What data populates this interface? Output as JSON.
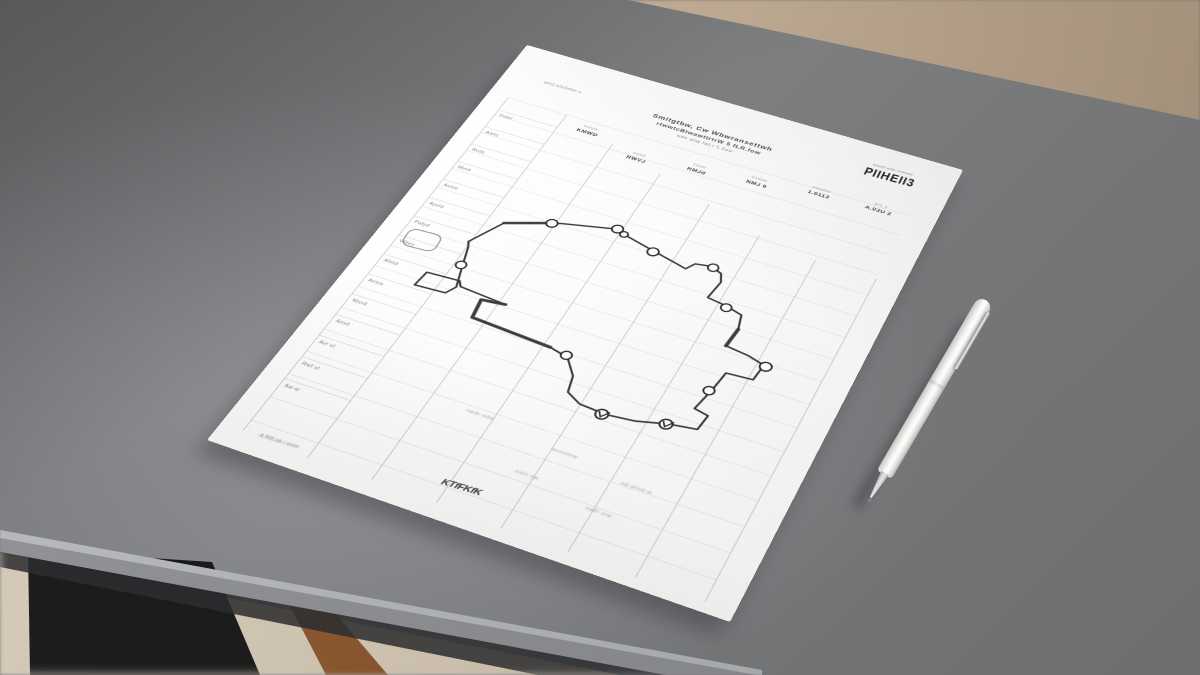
{
  "scene": {
    "description": "Photograph: printed worksheet with hand-drawn flowchart loop on a gray desk, white ballpoint pen beside it, wooden floor beyond desk edges, dark bag and wooden table leg visible under the front edge",
    "objects": [
      "paper-worksheet",
      "ballpoint-pen",
      "gray-desk",
      "wood-floor",
      "table-leg",
      "dark-bag"
    ],
    "colors": {
      "desk": "#757779",
      "desk_edge_highlight": "#b8babc",
      "floor_upper": "#c0ab94",
      "floor_lower": "#cfc3b2",
      "wood_leg": "#8a5a33",
      "bag": "#131316",
      "paper": "#fbfbfa",
      "ink": "#2b2b33",
      "grid_line": "#b6b7bd",
      "pen_body": "#f5f4f2",
      "pen_metal": "#b9babc"
    }
  },
  "paper": {
    "corner_note": "wnd-ataSdwr-c",
    "title_line1": "Smitgtbw, Cw Wbwransettwh",
    "title_line2": "rtwwtcBtwawttrtrW 5 fLR.fow",
    "title_line3": "wde wtw fwLr 5.5ow",
    "stamp_caption": "wswd wde mrtwwr",
    "stamp_text": "PIIHEII3",
    "columns": [
      {
        "caption": "swdew",
        "label": "KMWD"
      },
      {
        "caption": "wwwd",
        "label": "RWVJ"
      },
      {
        "caption": "svwdr",
        "label": "RMJd"
      },
      {
        "caption": "wzdww",
        "label": "NMJ 6"
      },
      {
        "caption": "wvwdew",
        "label": "1.0113"
      },
      {
        "caption": "wrv. s",
        "label": "A.03U 2"
      }
    ],
    "row_labels": [
      "YnfoI",
      "AIets",
      "Nvds",
      "Mvrd",
      "Avine",
      "AyvId",
      "Pafyd",
      "VIhey",
      "Afetd",
      "Avsrs",
      "Ntvrd",
      "AnviI",
      "Avr vI",
      "Rwf vI",
      "Aw-w"
    ],
    "footer_notes": [
      "nwdr-edw",
      "wvnvrew",
      "ed wIvd-w",
      "Avin vw"
    ],
    "bottom_note": "nwfr vIw",
    "signature": "KTfFKfK",
    "signature_note": "A.fWLwk i wvnr",
    "diagram": {
      "type": "hand-drawn flow loop",
      "node_count": 11
    }
  },
  "pen": {
    "style": "white ballpoint pen with silver clip and metal tip"
  }
}
